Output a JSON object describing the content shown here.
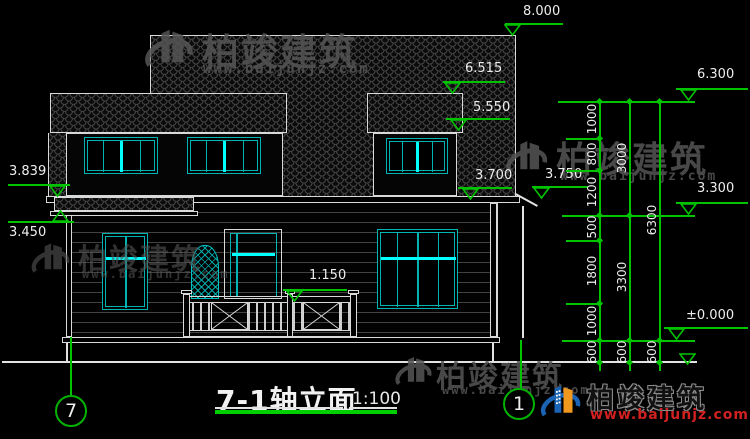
{
  "watermark": {
    "brand": "柏竣建筑",
    "url": "www.baijunjz.com"
  },
  "footer_logo": {
    "brand": "柏竣建筑",
    "url": "www.baijunjz.com"
  },
  "title_block": {
    "title": "7-1轴立面",
    "scale": "1:100"
  },
  "axes": {
    "left_bubble": "7",
    "right_bubble": "1"
  },
  "elevation_marks": {
    "ridge": "8.000",
    "dormer_roof": "6.515",
    "dormer_eave": "5.550",
    "main_eave": "3.700",
    "side_eave": "3.750",
    "left_eave_top": "3.839",
    "left_eave_bottom": "3.450",
    "porch_rail": "1.150",
    "right_top": "6.300",
    "right_mid": "3.300",
    "right_zero": "±0.000"
  },
  "dims": {
    "col1": [
      "1000",
      "800",
      "1200",
      "500",
      "1800",
      "1000",
      "600"
    ],
    "col2": [
      "3000",
      "3300",
      "600"
    ],
    "col3": [
      "6300",
      "600"
    ]
  },
  "colors": {
    "dim_green": "#00c400",
    "cyan_frame": "#00b4b4",
    "cyan_bright": "#00ffff",
    "white_line": "#e2e2e2",
    "logo_blue": "#1b64b5",
    "logo_orange": "#f0981e",
    "url_red": "#d02020"
  }
}
